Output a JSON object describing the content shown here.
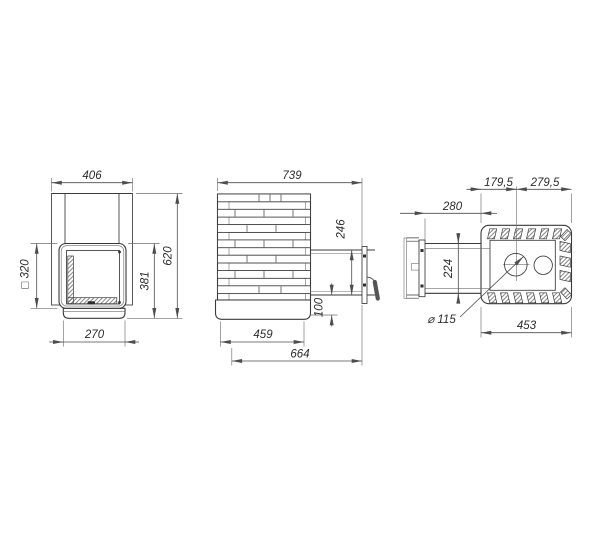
{
  "views": {
    "front": {
      "dims": {
        "overall_width": "406",
        "door_square": "□ 320",
        "overall_height": "620",
        "door_height": "381",
        "base_width": "270"
      }
    },
    "side": {
      "dims": {
        "overall_length": "739",
        "tunnel_height": "246",
        "base_offset_height": "100",
        "base_length": "459",
        "length_with_tunnel": "664"
      }
    },
    "top": {
      "dims": {
        "chimney_offset_front": "179,5",
        "chimney_offset_rear": "279,5",
        "tunnel_length": "280",
        "tunnel_width": "224",
        "chimney_diameter": "⌀ 115",
        "body_width": "453"
      }
    }
  },
  "colors": {
    "line": "#3a3a3a",
    "dim_line": "#4d4d4d",
    "text": "#2b2b2b",
    "background": "#ffffff"
  }
}
